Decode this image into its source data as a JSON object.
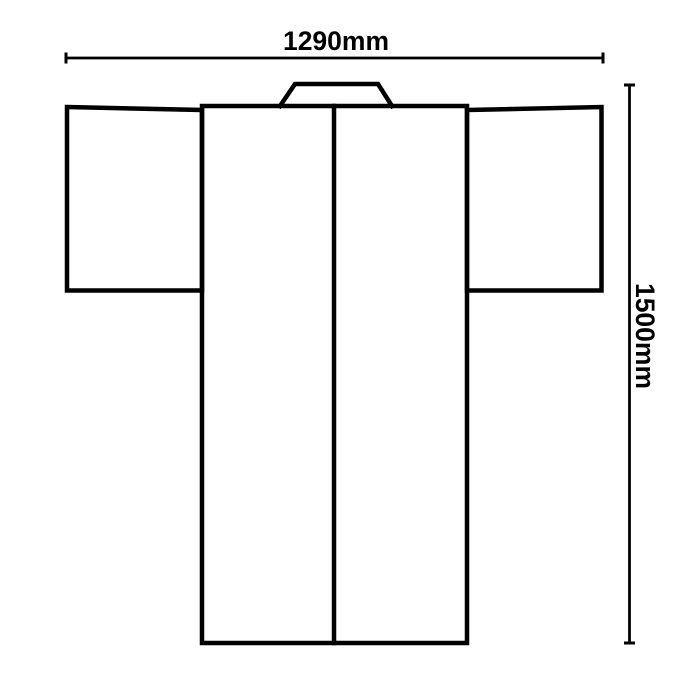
{
  "diagram": {
    "subject": "kimono-flat-technical-drawing",
    "background_color": "#ffffff",
    "line_color": "#000000",
    "width_dimension": {
      "label": "1290mm",
      "position": "top"
    },
    "height_dimension": {
      "label": "1500mm",
      "position": "right"
    }
  }
}
